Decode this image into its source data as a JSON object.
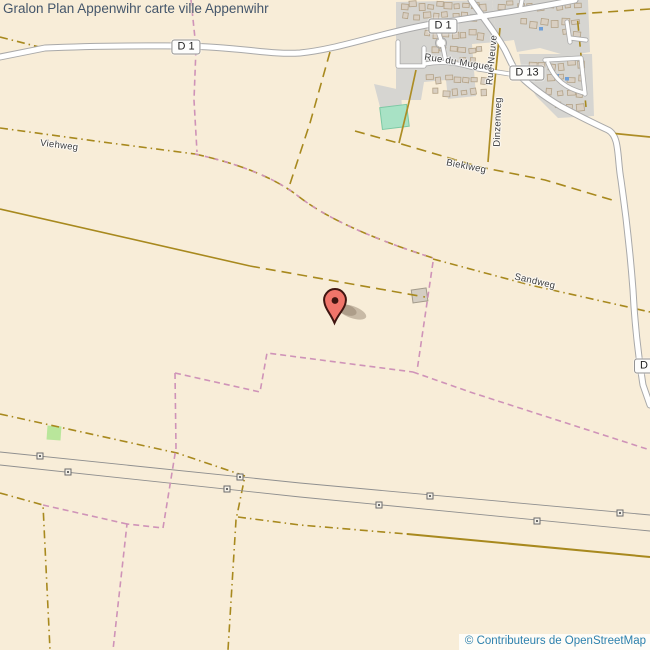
{
  "page": {
    "title": "Gralon Plan Appenwihr carte ville Appenwihr"
  },
  "attribution": {
    "text": "© Contributeurs de OpenStreetMap"
  },
  "badges": [
    {
      "label": "D 1"
    },
    {
      "label": "D 1"
    },
    {
      "label": "D 13"
    },
    {
      "label": "D 13"
    }
  ],
  "street_labels": [
    {
      "name": "Viehweg"
    },
    {
      "name": "Rue du Muguet"
    },
    {
      "name": "Rue Neuve"
    },
    {
      "name": "Dinzenweg"
    },
    {
      "name": "Bieklweg"
    },
    {
      "name": "Sandweg"
    }
  ],
  "marker": {
    "type": "location-pin"
  },
  "colors": {
    "background": "#f8edd8",
    "residential": "#d6d5d1",
    "building_fill": "#d9cfc2",
    "building_stroke": "#b3a287",
    "road_fill": "#ffffff",
    "road_casing": "#adadad",
    "track_olive": "#a8891e",
    "boundary_pink": "#cf93b8",
    "power_line_gray": "#8f8f8f",
    "pitch_teal": "#a8e2c5",
    "grass_green": "#b9e69b",
    "marker_red": "#f0756a",
    "attribution_blue": "#2d81ad",
    "title_gray_blue": "#44566b"
  }
}
